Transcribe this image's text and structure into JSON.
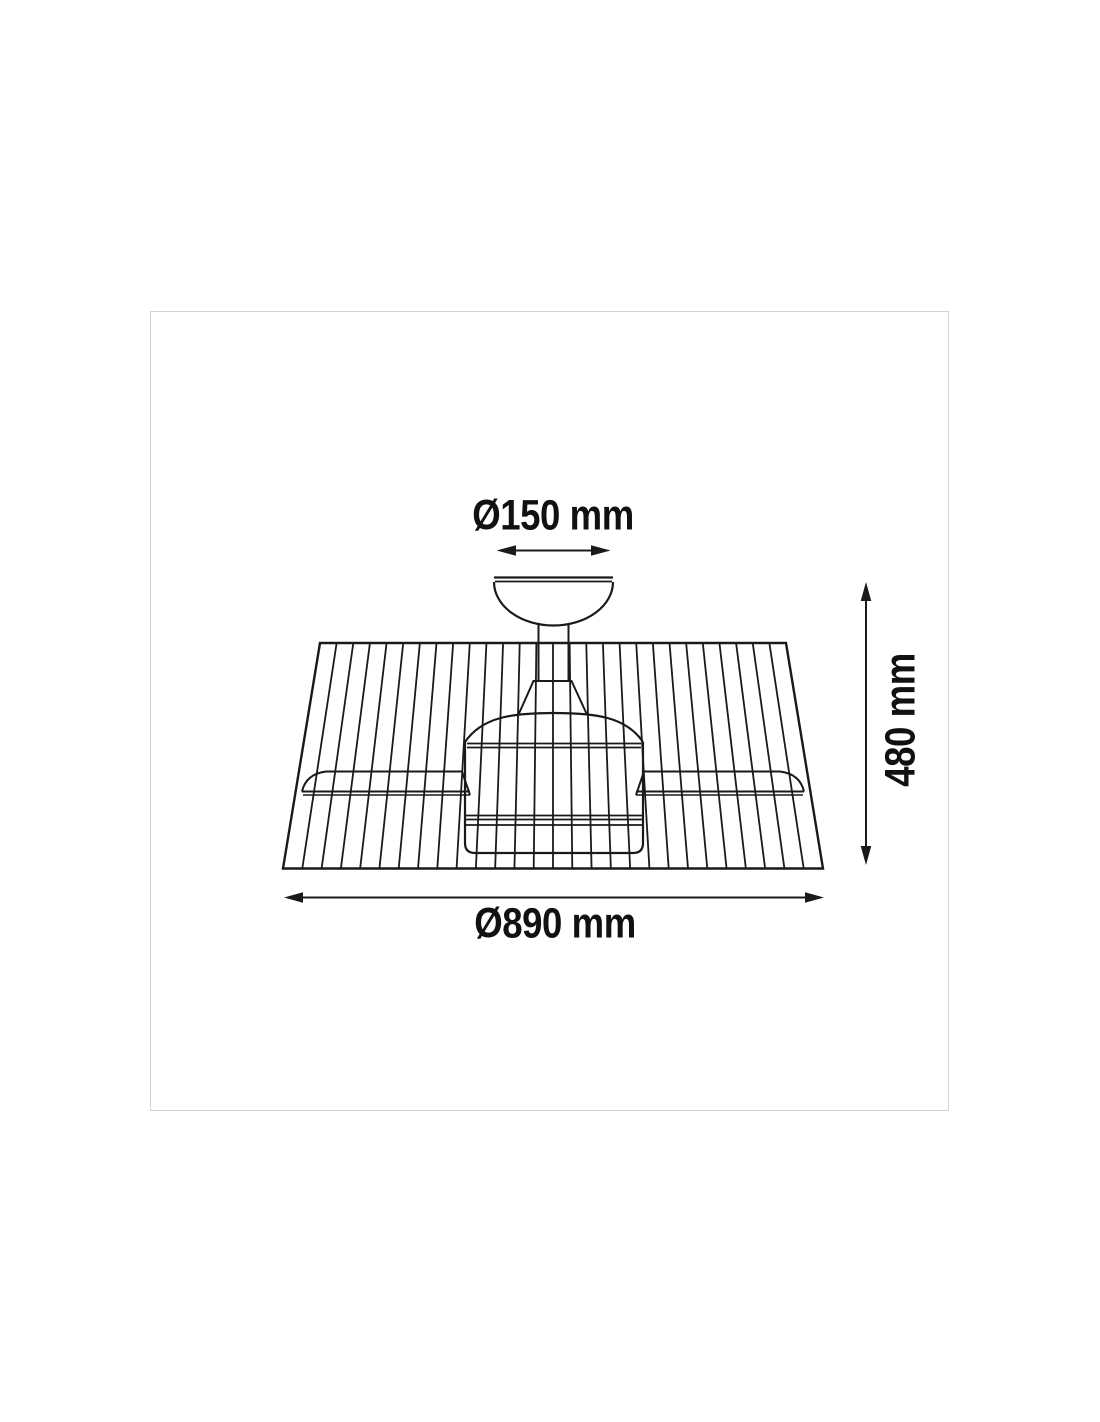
{
  "figure": {
    "type": "technical-dimension-drawing",
    "subject": "ceiling fan with cylindrical slatted cage shade, motor body, two blades and ceiling canopy (side view)",
    "background_color": "#ffffff",
    "line_color": "#1a1a1a",
    "frame_border_color": "#d2d2d2",
    "dimensions": {
      "canopy_diameter_label": "Ø150 mm",
      "height_label": "480 mm",
      "overall_diameter_label": "Ø890 mm"
    },
    "drawing": {
      "slat_count": 29
    }
  }
}
